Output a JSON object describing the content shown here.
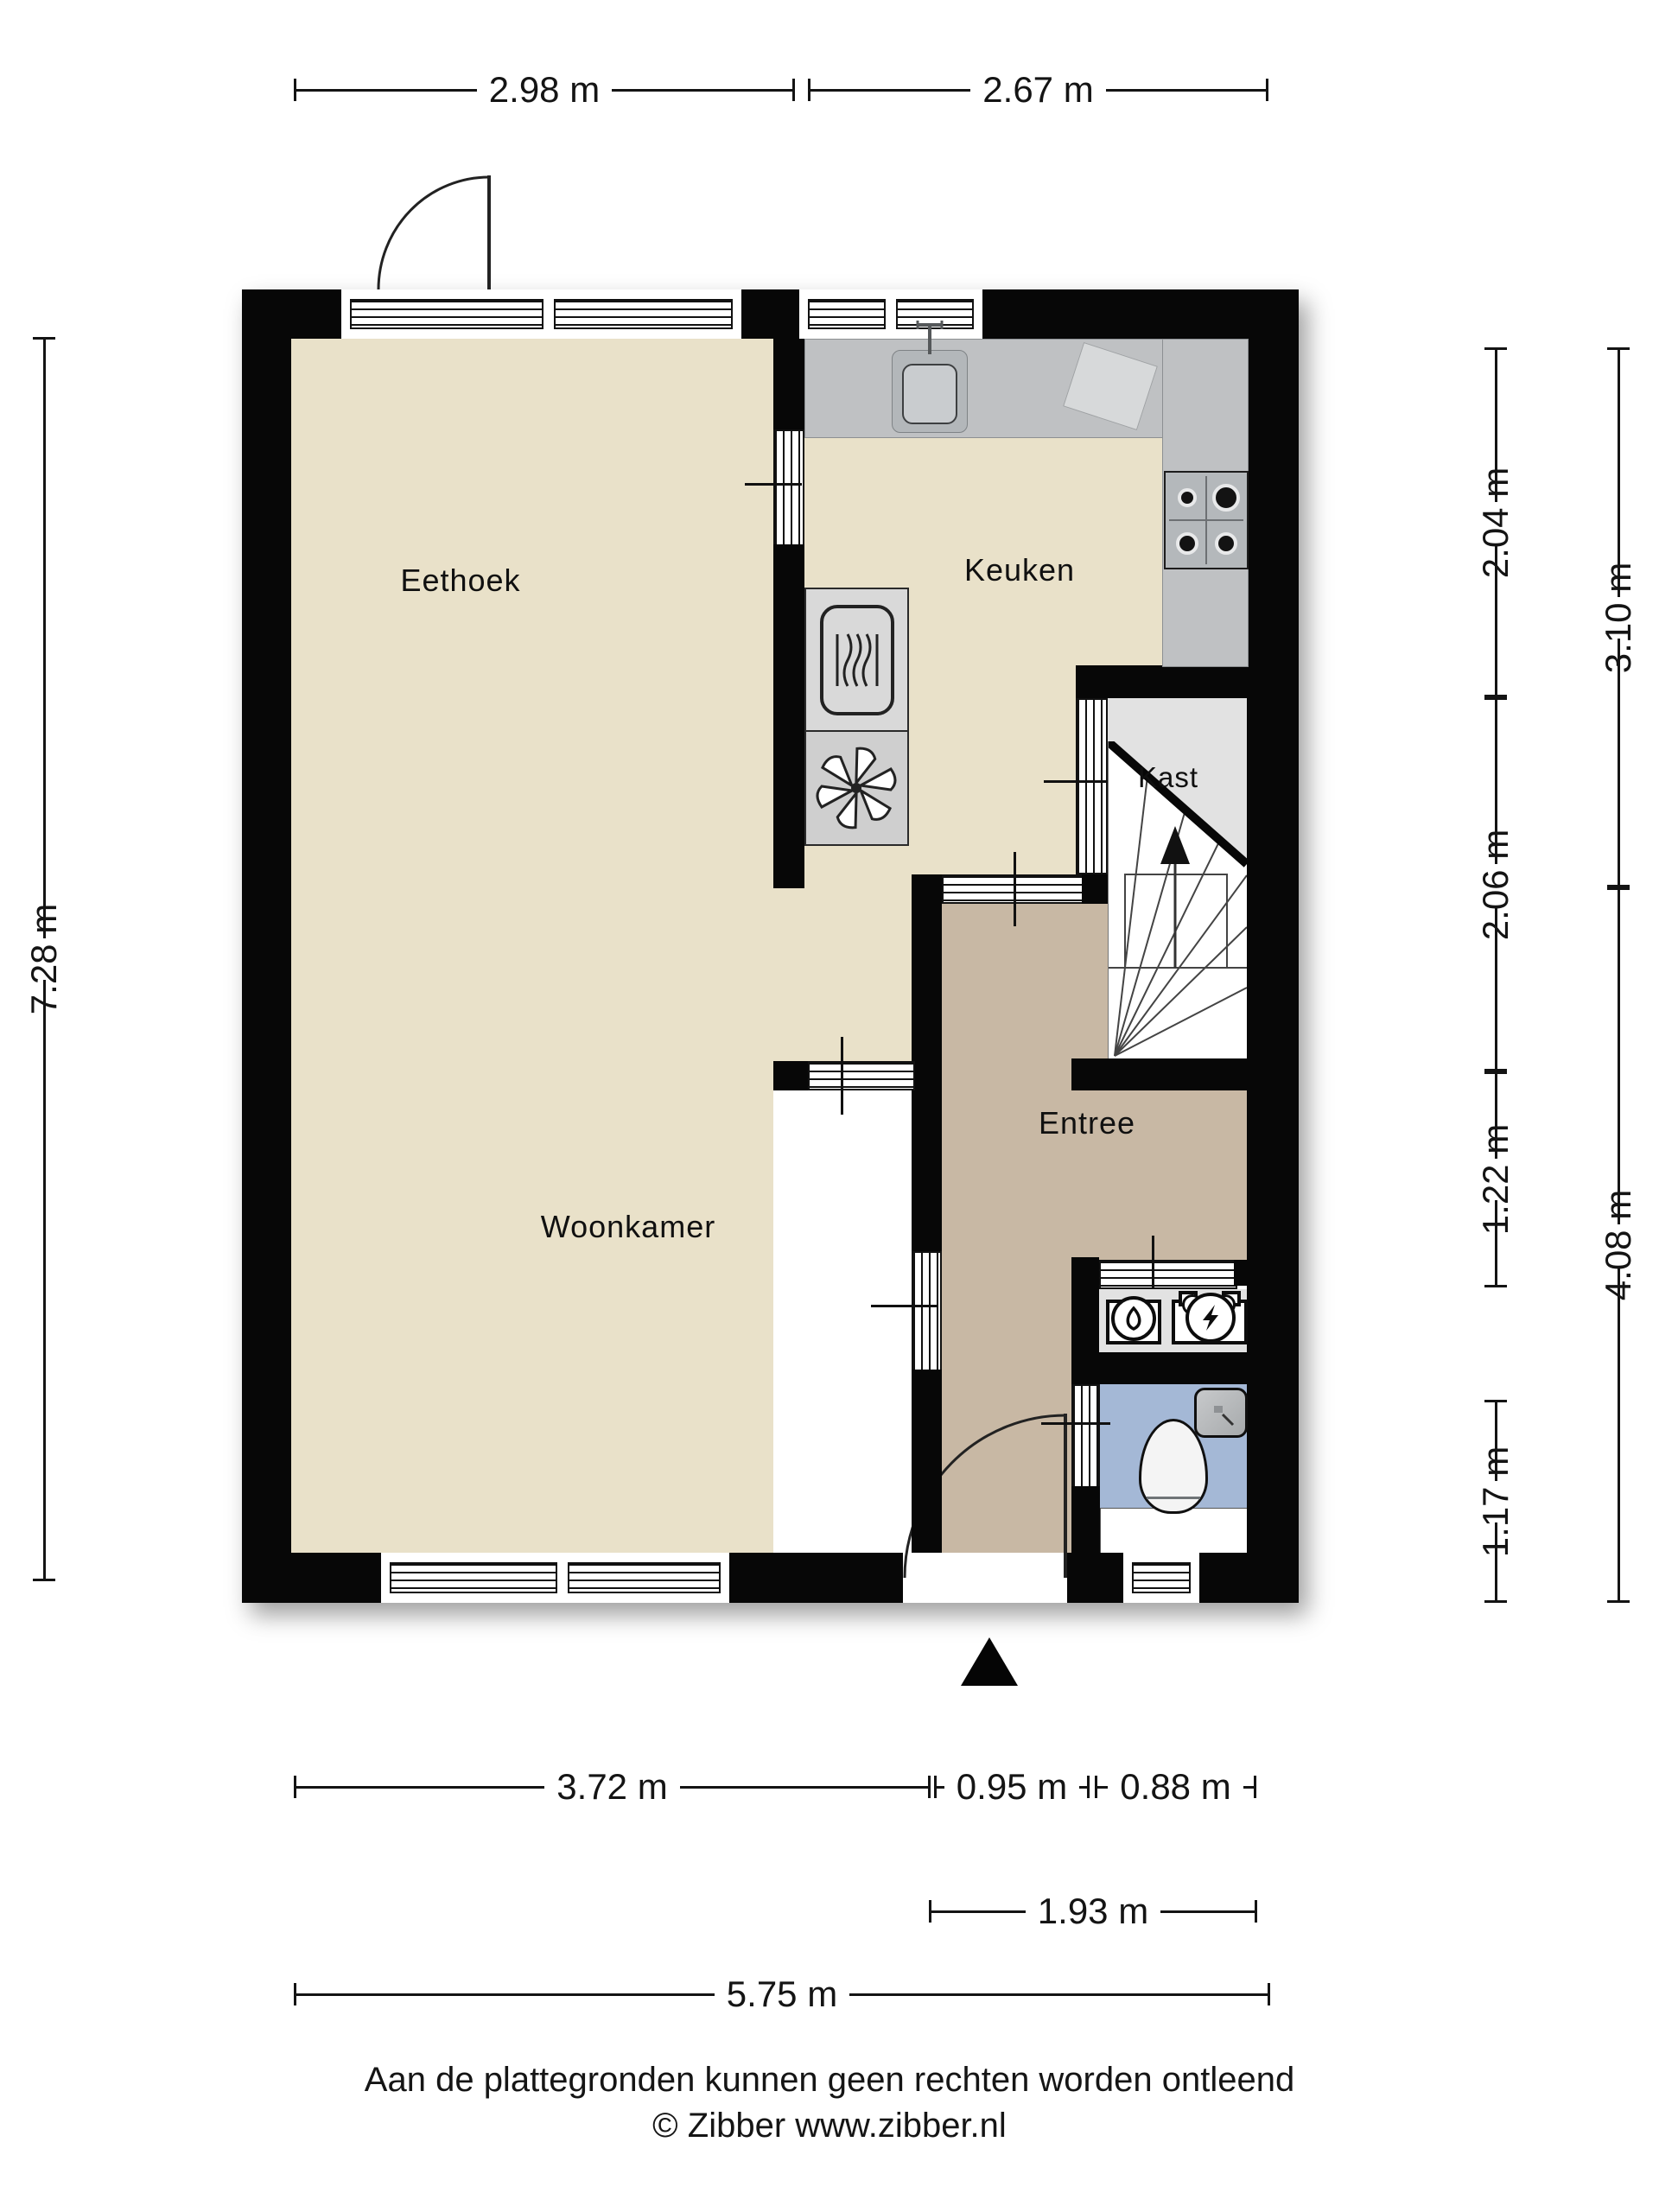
{
  "rooms": {
    "eethoek": "Eethoek",
    "keuken": "Keuken",
    "kast": "Kast",
    "entree": "Entree",
    "woonkamer": "Woonkamer"
  },
  "dimensions": {
    "top": [
      "2.98 m",
      "2.67 m"
    ],
    "left": [
      "7.28 m"
    ],
    "right_inner": [
      "2.04 m",
      "2.06 m",
      "1.22 m",
      "1.17 m"
    ],
    "right_outer": [
      "3.10 m",
      "4.08 m"
    ],
    "bottom_row1": [
      "3.72 m",
      "0.95 m",
      "0.88 m"
    ],
    "bottom_row2": [
      "1.93 m"
    ],
    "bottom_row3": [
      "5.75 m"
    ]
  },
  "footer": {
    "disclaimer": "Aan de plattegronden kunnen geen rechten worden ontleend",
    "copyright": "© Zibber www.zibber.nl"
  },
  "colors": {
    "wall": "#070707",
    "cream": "#e9e1c9",
    "tan": "#c8b8a4",
    "blue": "#a4b8d6",
    "grayfloor": "#e2e2e2",
    "counter": "#bfc1c3"
  }
}
